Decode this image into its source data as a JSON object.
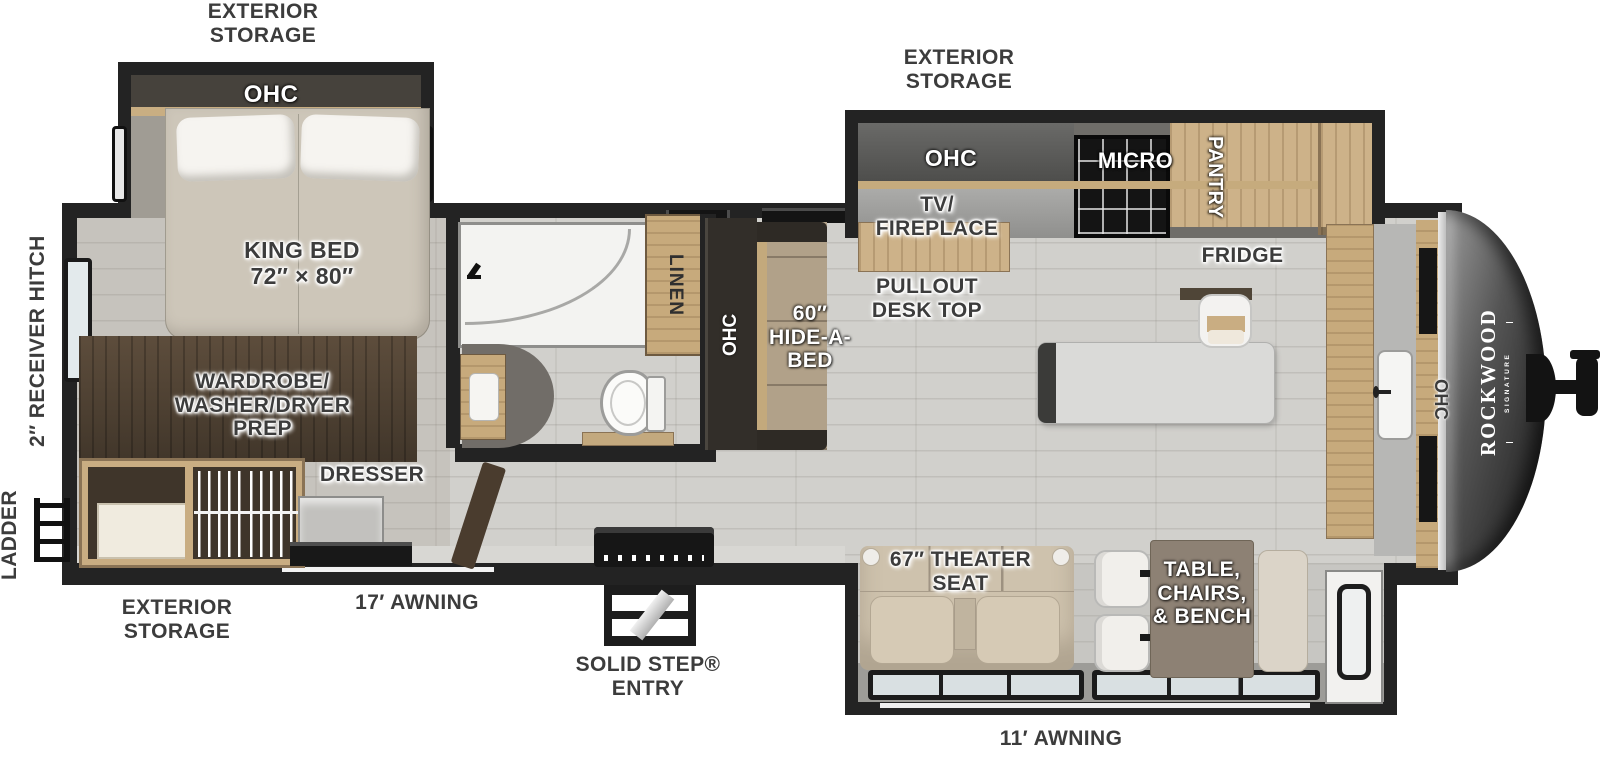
{
  "plan": {
    "brand": {
      "name": "ROCKWOOD",
      "sub": "SIGNATURE"
    },
    "labels": {
      "storage_top_left": "EXTERIOR\nSTORAGE",
      "storage_top_right": "EXTERIOR\nSTORAGE",
      "storage_bottom_left": "EXTERIOR\nSTORAGE",
      "awning_17": "17′ AWNING",
      "awning_11": "11′ AWNING",
      "receiver_hitch": "2″ RECEIVER HITCH",
      "ladder": "LADDER",
      "solid_step": "SOLID STEP®\nENTRY",
      "bedroom_ohc": "OHC",
      "king_bed": "KING BED\n72″ × 80″",
      "tv_opt": "TV Opt.",
      "wardrobe": "WARDROBE/\nWASHER/DRYER\nPREP",
      "dresser": "DRESSER",
      "linen": "LINEN",
      "sofa_ohc": "OHC",
      "hide_a_bed": "60″\nHIDE-A-\nBED",
      "tv_fireplace": "TV/\nFIREPLACE",
      "pullout_desk": "PULLOUT\nDESK TOP",
      "kitchen_ohc": "OHC",
      "micro": "MICRO",
      "pantry": "PANTRY",
      "fridge": "FRIDGE",
      "theater_seat": "67″ THEATER\nSEAT",
      "dinette": "TABLE,\nCHAIRS,\n& BENCH",
      "front_ohc": "OHC"
    },
    "colors": {
      "wall": "#232323",
      "floor": "#d1d0cc",
      "wood": "#cdb289",
      "dark_wood": "#4f4130",
      "nose": "#2b2b2b",
      "label_text": "#3c3c3c"
    }
  }
}
